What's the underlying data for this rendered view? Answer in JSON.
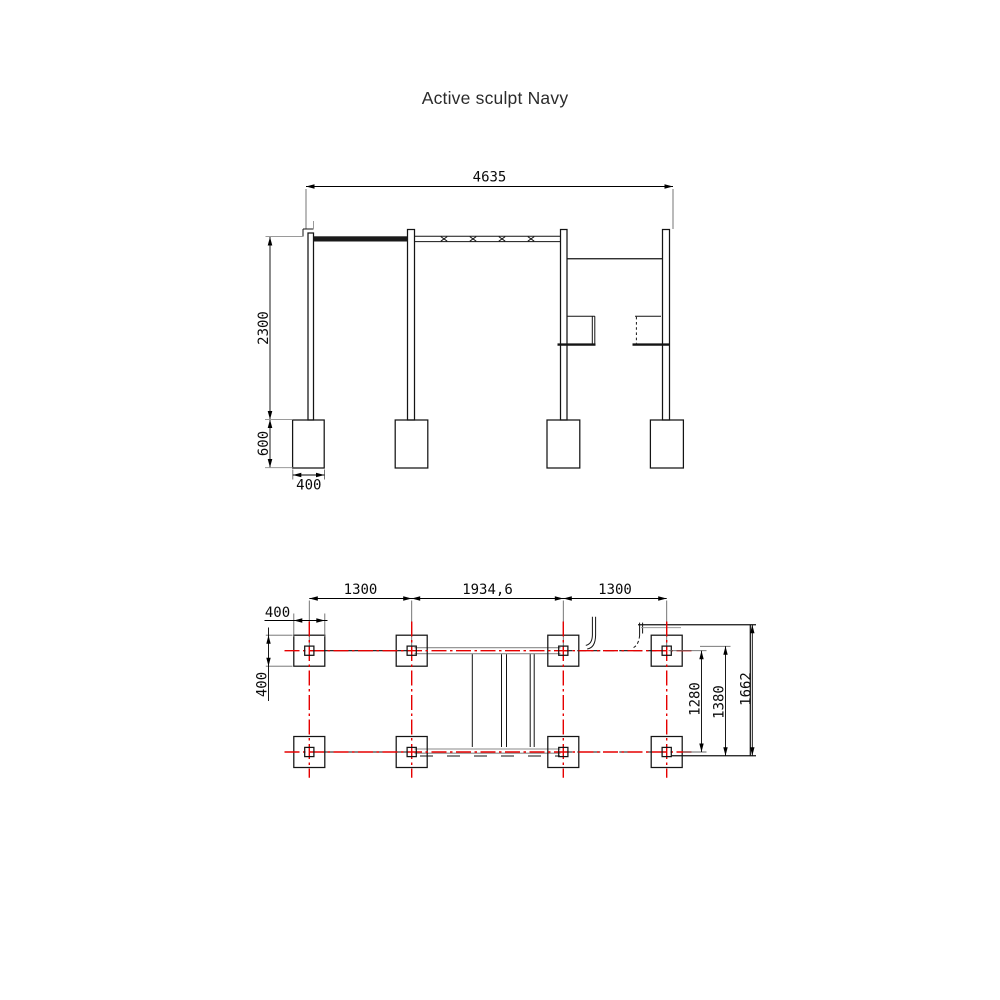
{
  "title": "Active sculpt Navy",
  "colors": {
    "line": "#141414",
    "centerline_red": "#e60000",
    "rail_gray": "#8a8a8a",
    "background": "#ffffff"
  },
  "elevation": {
    "label": "front-elevation",
    "dims": {
      "overall_width": "4635",
      "height": "2300",
      "footing_depth": "600",
      "footing_width": "400"
    }
  },
  "plan": {
    "label": "foundation-plan",
    "dims": {
      "bay_left": "1300",
      "bay_middle": "1934,6",
      "bay_right": "1300",
      "footing_width": "400",
      "footing_height": "400",
      "row_spacing": "1280",
      "frame_depth": "1380",
      "overall_depth": "1662"
    }
  }
}
